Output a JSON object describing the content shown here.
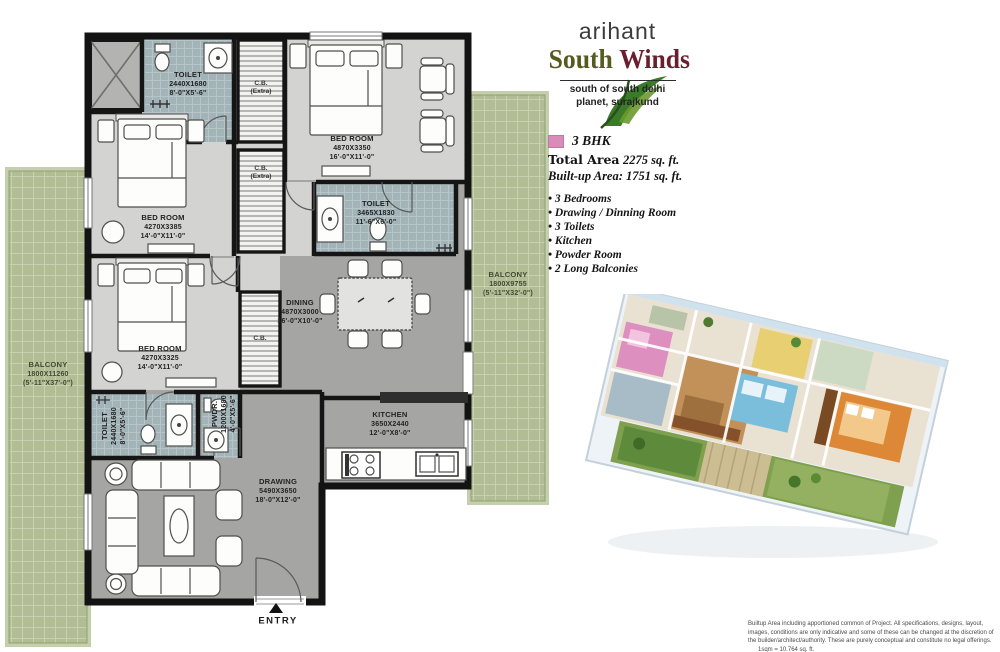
{
  "logo": {
    "brand": "arihant",
    "name_part1": "South",
    "name_part2": "Winds",
    "tagline1": "south of south delhi",
    "tagline2": "planet, surajkund",
    "south_color": "#565a1e",
    "winds_color": "#6b1f2e"
  },
  "specs": {
    "swatch_color": "#d98cba",
    "type": "3 BHK",
    "total_area_label": "Total Area",
    "total_area_value": "2275 sq. ft.",
    "builtup_area": "Built-up Area: 1751 sq. ft.",
    "features": [
      "3 Bedrooms",
      "Drawing / Dinning Room",
      "3 Toilets",
      "Kitchen",
      "Powder Room",
      "2 Long Balconies"
    ]
  },
  "floorplan": {
    "rooms": {
      "toilet_top": {
        "name": "TOILET",
        "dim": "2440X1680",
        "size": "8'-0\"X5'-6\""
      },
      "bedroom_top": {
        "name": "BED ROOM",
        "dim": "4870X3350",
        "size": "16'-0\"X11'-0\""
      },
      "bedroom_mid": {
        "name": "BED ROOM",
        "dim": "4270X3385",
        "size": "14'-0\"X11'-0\""
      },
      "toilet_mid": {
        "name": "TOILET",
        "dim": "3465X1830",
        "size": "11'-6\"X6'-0\""
      },
      "bedroom_bottom": {
        "name": "BED ROOM",
        "dim": "4270X3325",
        "size": "14'-0\"X11'-0\""
      },
      "dining": {
        "name": "DINING",
        "dim": "4870X3000",
        "size": "16'-0\"X10'-0\""
      },
      "toilet_bottom": {
        "name": "TOILET",
        "dim": "2440X1680",
        "size": "8'-0\"X5'-6\""
      },
      "powder": {
        "name": "PWDR.",
        "dim": "1200X1680",
        "size": "4'-0\"X5'-6\""
      },
      "kitchen": {
        "name": "KITCHEN",
        "dim": "3650X2440",
        "size": "12'-0\"X8'-0\""
      },
      "drawing": {
        "name": "DRAWING",
        "dim": "5490X3650",
        "size": "18'-0\"X12'-0\""
      },
      "balcony_left": {
        "name": "BALCONY",
        "dim": "1800X11260",
        "size": "(5'-11\"X37'-0\")"
      },
      "balcony_right": {
        "name": "BALCONY",
        "dim": "1800X9755",
        "size": "(5'-11\"X32'-0\")"
      }
    },
    "cb1": {
      "name": "C.B.",
      "sub": "(Extra)"
    },
    "cb2": {
      "name": "C.B.",
      "sub": "(Extra)"
    },
    "cb3": {
      "name": "C.B."
    },
    "entry_label": "ENTRY",
    "colors": {
      "balcony_green": "#b2bd96",
      "tile_blue": "#a3b4b9",
      "floor_light": "#d3d3d1",
      "floor_dark": "#a5a5a3",
      "wall": "#151515"
    }
  },
  "disclaimer": {
    "text": "Builtup Area including apportioned common of Project. All specifications, designs, layout, images, conditions are only indicative and some of these can be changed at the discretion of the builder/architect/authority. These are purely conceptual and constitute no legal offerings.",
    "conversion": "1sqm = 10.764 sq. ft."
  }
}
